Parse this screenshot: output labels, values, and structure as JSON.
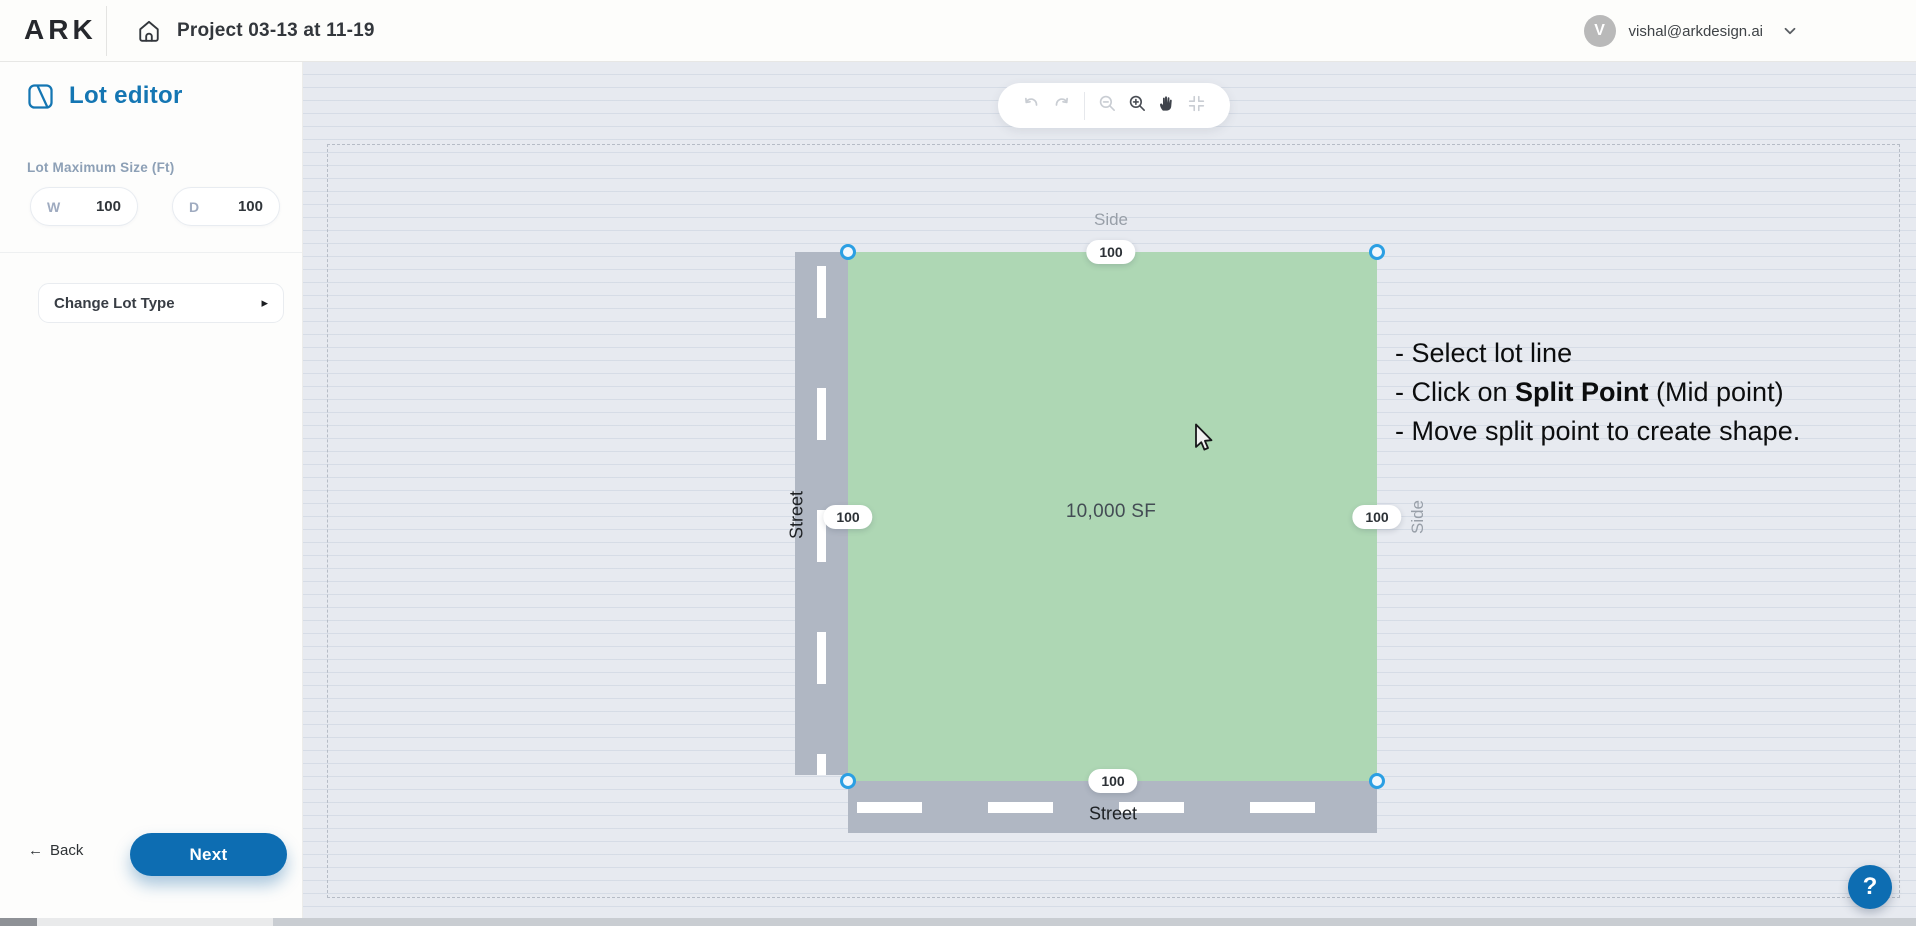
{
  "header": {
    "logo_text": "ARK",
    "project_title": "Project 03-13 at 11-19",
    "user": {
      "avatar_initial": "V",
      "email": "vishal@arkdesign.ai"
    }
  },
  "sidebar": {
    "panel_title": "Lot editor",
    "lot_size_label": "Lot Maximum Size (Ft)",
    "width_field": {
      "label": "W",
      "value": "100"
    },
    "depth_field": {
      "label": "D",
      "value": "100"
    },
    "change_lot_type": {
      "label": "Change Lot Type",
      "caret": "▸"
    },
    "back": {
      "arrow": "←",
      "label": "Back"
    },
    "next_label": "Next"
  },
  "toolbar": {
    "buttons": [
      "undo",
      "redo",
      "zoom-out",
      "zoom-in",
      "pan",
      "fit-view"
    ]
  },
  "lot": {
    "area_label": "10,000 SF",
    "labels": {
      "top": "Side",
      "right": "Side",
      "left": "Street",
      "bottom": "Street"
    },
    "dimensions": {
      "top": "100",
      "right": "100",
      "left": "100",
      "bottom": "100"
    }
  },
  "instructions": {
    "line1": "- Select lot line",
    "line2_pre": "- Click on ",
    "line2_bold": "Split Point",
    "line2_post": " (Mid point)",
    "line3": "- Move split point to create shape."
  },
  "help_label": "?",
  "colors": {
    "accent_blue": "#1476b3",
    "button_blue": "#0d6db2",
    "lot_green": "#aed7b4",
    "road_gray": "#b0b7c3",
    "handle_blue": "#2b9fe3",
    "canvas_bg": "#e7eaf0"
  }
}
